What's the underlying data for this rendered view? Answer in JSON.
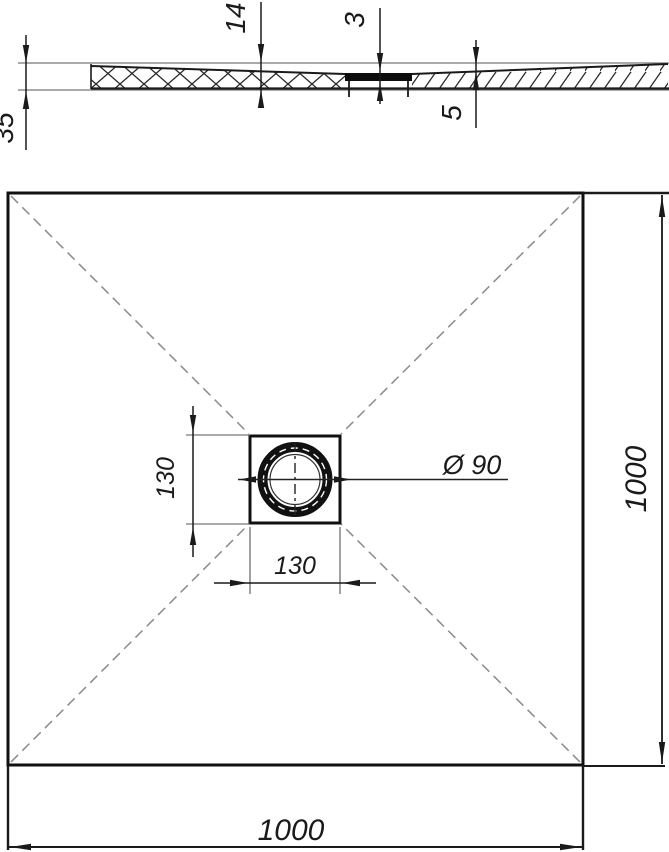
{
  "drawing_title": "Square shower tray technical drawing",
  "section_view": {
    "dim_total_height": "35",
    "dim_depth": "14",
    "dim_cover_thickness": "3",
    "dim_edge_thickness": "5"
  },
  "plan_view": {
    "dim_width_bottom": "1000",
    "dim_height_right": "1000",
    "dim_drain_box_width": "130",
    "dim_drain_box_height": "130",
    "dim_drain_diameter": "Ø 90"
  },
  "colors": {
    "main_line": "#1a1a1a",
    "thin_line": "#787878",
    "dashed_line": "#8a8a8a",
    "background": "#ffffff"
  }
}
